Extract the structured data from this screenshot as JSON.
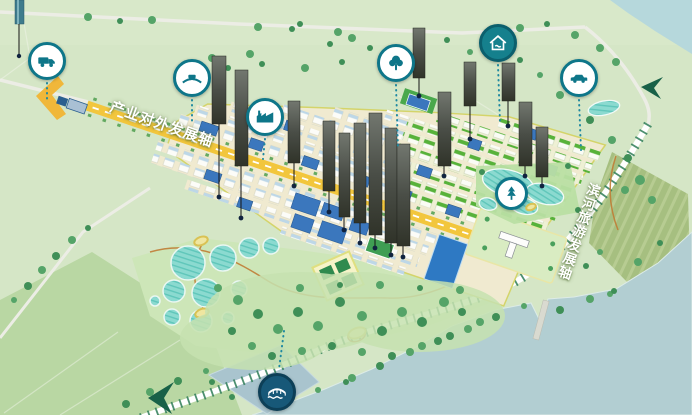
{
  "map": {
    "axis_labels": {
      "industry": "产业对外发展轴",
      "riverside": "滨河旅游发展轴"
    },
    "icons": [
      {
        "name": "truck-icon"
      },
      {
        "name": "bridge-car-icon"
      },
      {
        "name": "factory-icon"
      },
      {
        "name": "tree-icon"
      },
      {
        "name": "homestay-icon"
      },
      {
        "name": "car-icon"
      },
      {
        "name": "park-tree-icon"
      },
      {
        "name": "lake-bridge-icon"
      }
    ],
    "colors": {
      "axis_road": "#f2c63d",
      "icon_teal": "#0e7689",
      "water": "#b2ced2",
      "city_green_roof": "#57b23a",
      "city_blue_roof": "#3b77bd",
      "tower_dark": "#3c403b",
      "farmland": "#a6bf80"
    }
  }
}
